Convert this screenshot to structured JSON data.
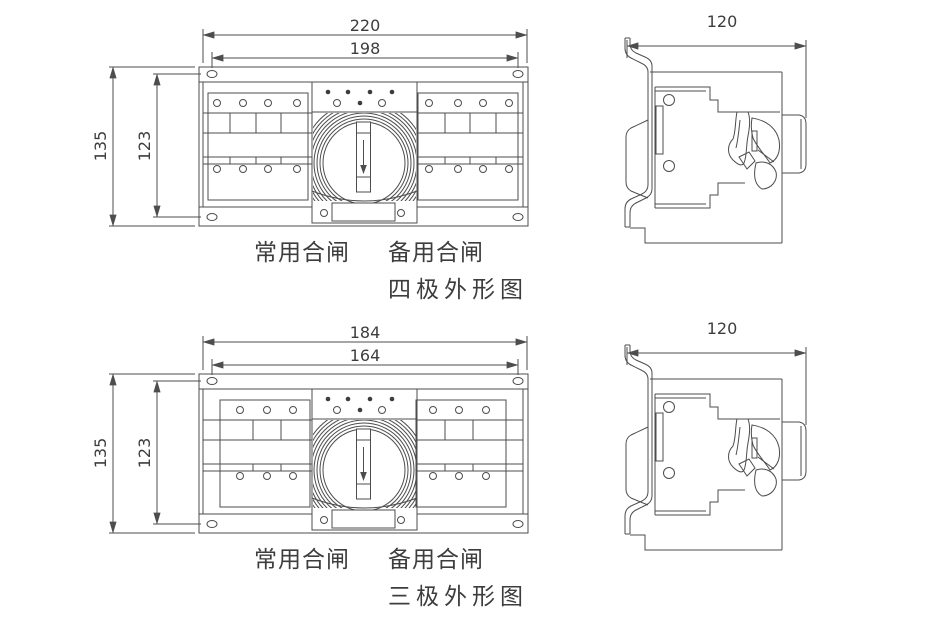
{
  "page": {
    "background": "#ffffff",
    "line_color": "#4d4d4d",
    "text_color": "#3d3d3d"
  },
  "four_pole": {
    "title": "四极外形图",
    "front_view": {
      "dim_overall_width": "220",
      "dim_hole_span_width": "198",
      "dim_overall_height": "135",
      "dim_hole_span_height": "123",
      "label_normal_close": "常用合闸",
      "label_reserve_close": "备用合闸"
    },
    "side_view": {
      "dim_depth": "120"
    }
  },
  "three_pole": {
    "title": "三极外形图",
    "front_view": {
      "dim_overall_width": "184",
      "dim_hole_span_width": "164",
      "dim_overall_height": "135",
      "dim_hole_span_height": "123",
      "label_normal_close": "常用合闸",
      "label_reserve_close": "备用合闸"
    },
    "side_view": {
      "dim_depth": "120"
    }
  }
}
